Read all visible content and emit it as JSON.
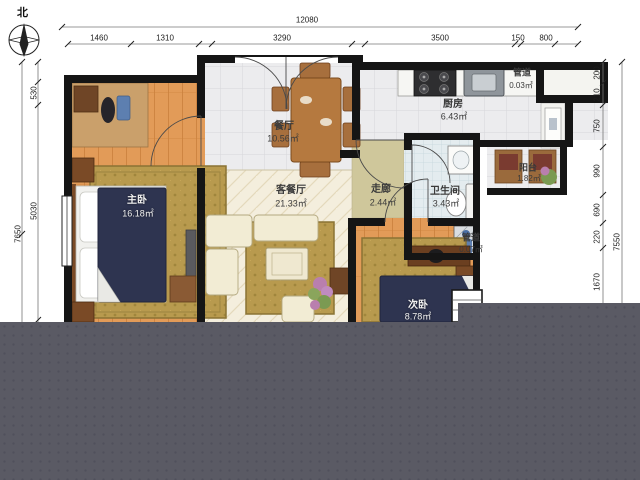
{
  "compass": {
    "north_label": "北"
  },
  "dimensions": {
    "top_total": "12080",
    "top": [
      "1460",
      "1310",
      "3290",
      "3500",
      "150",
      "800"
    ],
    "left": [
      "530",
      "5030"
    ],
    "left_total": "7650",
    "right": [
      "200",
      "210",
      "750",
      "990",
      "690",
      "220",
      "1670"
    ],
    "right_total": "7550"
  },
  "rooms": [
    {
      "name": "主卧",
      "area": "16.18㎡"
    },
    {
      "name": "餐厅",
      "area": "10.56㎡"
    },
    {
      "name": "客餐厅",
      "area": "21.33㎡"
    },
    {
      "name": "厨房",
      "area": "6.43㎡"
    },
    {
      "name": "走廊",
      "area": "2.44㎡"
    },
    {
      "name": "卫生间",
      "area": "3.43㎡"
    },
    {
      "name": "阳台",
      "area": "1.82㎡"
    },
    {
      "name": "次卧",
      "area": "8.78㎡"
    },
    {
      "name": "管道",
      "area": "0.03㎡"
    },
    {
      "name": "管道",
      "area": "0.07㎡"
    }
  ],
  "colors": {
    "wall": "#151515",
    "wood_floor": "#e29b58",
    "bed": "#2e3450",
    "rug": "#b89a4e",
    "overlay_gray": "#5a5a64",
    "corridor": "#cfc79b",
    "living_floor": "#f4eedd"
  }
}
